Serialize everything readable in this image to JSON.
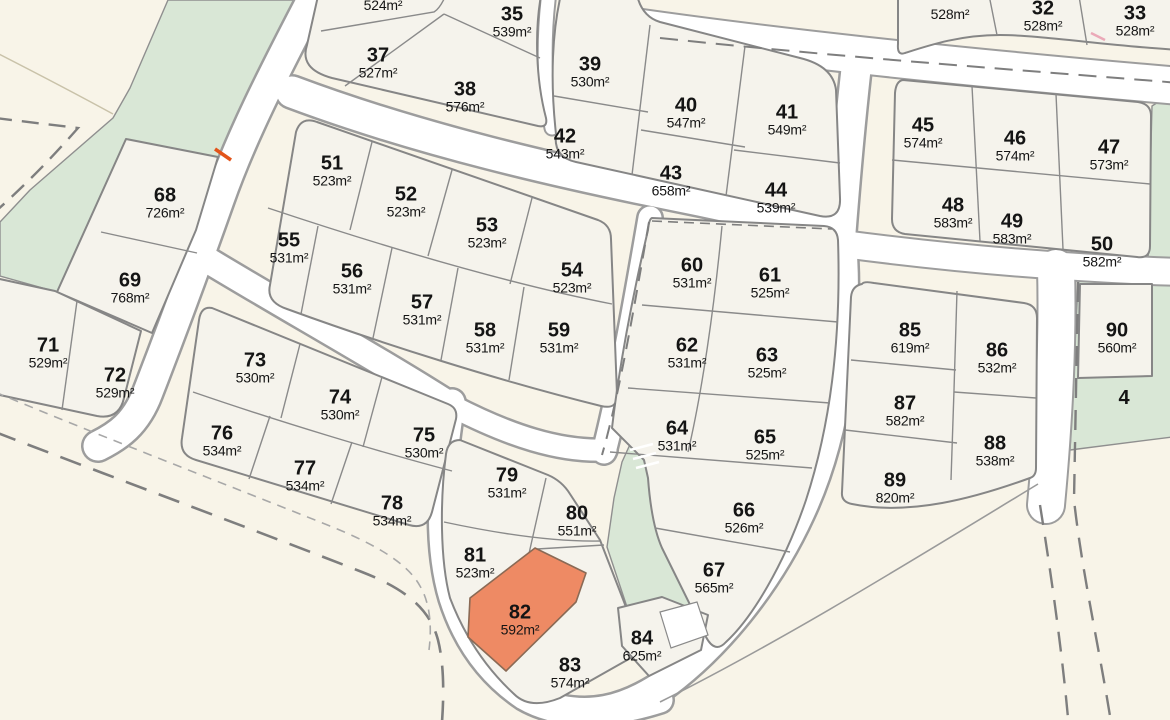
{
  "map": {
    "type": "subdivision-plat-map",
    "selected_lot": "82",
    "colors": {
      "background": "#f8f4e8",
      "lot_fill": "#f5f3ec",
      "road_fill": "#ffffff",
      "park_fill": "#d9e7d6",
      "boundary_gray": "#8a8a8a",
      "highlight_fill": "#ee8a64",
      "label_color": "#141414",
      "survey_tick_orange": "#e2541a",
      "survey_tick_pink": "#eba9b8"
    },
    "park_labels": [
      {
        "number": "4",
        "x": 1124,
        "y": 398
      }
    ],
    "lots": [
      {
        "number": "",
        "area": "524m²",
        "x": 383,
        "y": 5
      },
      {
        "number": "35",
        "area": "539m²",
        "x": 512,
        "y": 22
      },
      {
        "number": "37",
        "area": "527m²",
        "x": 378,
        "y": 63
      },
      {
        "number": "38",
        "area": "576m²",
        "x": 465,
        "y": 97
      },
      {
        "number": "39",
        "area": "530m²",
        "x": 590,
        "y": 72
      },
      {
        "number": "40",
        "area": "547m²",
        "x": 686,
        "y": 113
      },
      {
        "number": "41",
        "area": "549m²",
        "x": 787,
        "y": 120
      },
      {
        "number": "42",
        "area": "543m²",
        "x": 565,
        "y": 144
      },
      {
        "number": "43",
        "area": "658m²",
        "x": 671,
        "y": 181
      },
      {
        "number": "44",
        "area": "539m²",
        "x": 776,
        "y": 198
      },
      {
        "number": "",
        "area": "528m²",
        "x": 950,
        "y": 14
      },
      {
        "number": "32",
        "area": "528m²",
        "x": 1043,
        "y": 16
      },
      {
        "number": "33",
        "area": "528m²",
        "x": 1135,
        "y": 21
      },
      {
        "number": "45",
        "area": "574m²",
        "x": 923,
        "y": 133
      },
      {
        "number": "46",
        "area": "574m²",
        "x": 1015,
        "y": 146
      },
      {
        "number": "47",
        "area": "573m²",
        "x": 1109,
        "y": 155
      },
      {
        "number": "48",
        "area": "583m²",
        "x": 953,
        "y": 213
      },
      {
        "number": "49",
        "area": "583m²",
        "x": 1012,
        "y": 229
      },
      {
        "number": "50",
        "area": "582m²",
        "x": 1102,
        "y": 252
      },
      {
        "number": "51",
        "area": "523m²",
        "x": 332,
        "y": 171
      },
      {
        "number": "52",
        "area": "523m²",
        "x": 406,
        "y": 202
      },
      {
        "number": "53",
        "area": "523m²",
        "x": 487,
        "y": 233
      },
      {
        "number": "54",
        "area": "523m²",
        "x": 572,
        "y": 278
      },
      {
        "number": "55",
        "area": "531m²",
        "x": 289,
        "y": 248
      },
      {
        "number": "56",
        "area": "531m²",
        "x": 352,
        "y": 279
      },
      {
        "number": "57",
        "area": "531m²",
        "x": 422,
        "y": 310
      },
      {
        "number": "58",
        "area": "531m²",
        "x": 485,
        "y": 338
      },
      {
        "number": "59",
        "area": "531m²",
        "x": 559,
        "y": 338
      },
      {
        "number": "60",
        "area": "531m²",
        "x": 692,
        "y": 273
      },
      {
        "number": "61",
        "area": "525m²",
        "x": 770,
        "y": 283
      },
      {
        "number": "62",
        "area": "531m²",
        "x": 687,
        "y": 353
      },
      {
        "number": "63",
        "area": "525m²",
        "x": 767,
        "y": 363
      },
      {
        "number": "64",
        "area": "531m²",
        "x": 677,
        "y": 436
      },
      {
        "number": "65",
        "area": "525m²",
        "x": 765,
        "y": 445
      },
      {
        "number": "66",
        "area": "526m²",
        "x": 744,
        "y": 518
      },
      {
        "number": "67",
        "area": "565m²",
        "x": 714,
        "y": 578
      },
      {
        "number": "68",
        "area": "726m²",
        "x": 165,
        "y": 203
      },
      {
        "number": "69",
        "area": "768m²",
        "x": 130,
        "y": 288
      },
      {
        "number": "71",
        "area": "529m²",
        "x": 48,
        "y": 353
      },
      {
        "number": "72",
        "area": "529m²",
        "x": 115,
        "y": 383
      },
      {
        "number": "73",
        "area": "530m²",
        "x": 255,
        "y": 368
      },
      {
        "number": "74",
        "area": "530m²",
        "x": 340,
        "y": 405
      },
      {
        "number": "75",
        "area": "530m²",
        "x": 424,
        "y": 443
      },
      {
        "number": "76",
        "area": "534m²",
        "x": 222,
        "y": 441
      },
      {
        "number": "77",
        "area": "534m²",
        "x": 305,
        "y": 476
      },
      {
        "number": "78",
        "area": "534m²",
        "x": 392,
        "y": 511
      },
      {
        "number": "79",
        "area": "531m²",
        "x": 507,
        "y": 483
      },
      {
        "number": "80",
        "area": "551m²",
        "x": 577,
        "y": 521
      },
      {
        "number": "81",
        "area": "523m²",
        "x": 475,
        "y": 563
      },
      {
        "number": "82",
        "area": "592m²",
        "x": 520,
        "y": 620,
        "highlighted": true
      },
      {
        "number": "83",
        "area": "574m²",
        "x": 570,
        "y": 673
      },
      {
        "number": "84",
        "area": "625m²",
        "x": 642,
        "y": 646
      },
      {
        "number": "85",
        "area": "619m²",
        "x": 910,
        "y": 338
      },
      {
        "number": "86",
        "area": "532m²",
        "x": 997,
        "y": 358
      },
      {
        "number": "87",
        "area": "582m²",
        "x": 905,
        "y": 411
      },
      {
        "number": "88",
        "area": "538m²",
        "x": 995,
        "y": 451
      },
      {
        "number": "89",
        "area": "820m²",
        "x": 895,
        "y": 488
      },
      {
        "number": "90",
        "area": "560m²",
        "x": 1117,
        "y": 338
      }
    ]
  }
}
